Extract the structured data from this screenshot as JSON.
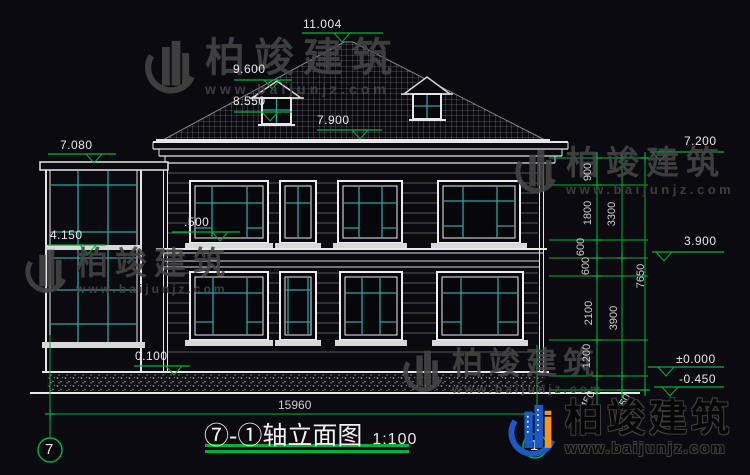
{
  "colors": {
    "background": "#0a0a10",
    "line_white": "#e6e6e6",
    "dim_green": "#00b23c",
    "glass_teal": "#2fa49e",
    "watermark_gray": "#464646",
    "logo_blue": "#1b59c4",
    "logo_orange": "#f6941e"
  },
  "labels": {
    "peak": "11.004",
    "roof_upper": "9.600",
    "roof_dormer": "8.550",
    "roof_eave": "7.900",
    "sunroom_top": "7.080",
    "sunroom_mid": "4.150",
    "floor2": ".500",
    "plinth": "0.100",
    "right_parapet": "7.200",
    "right_floor2": "3.900",
    "right_zero": "±0.000",
    "right_ground": "-0.450",
    "total_width": "15960"
  },
  "vdims": {
    "v900": "900",
    "v1800": "1800",
    "v600a": "600",
    "v600b": "600",
    "v2100": "2100",
    "v1200": "1200",
    "v450a": "450",
    "v3300": "3300",
    "v3900": "3900",
    "v450b": "450",
    "v7650": "7650"
  },
  "axes": {
    "left": "7",
    "right": "1"
  },
  "title": {
    "name": "⑦-①轴立面图",
    "scale": "1:100"
  },
  "brand": {
    "name": "柏竣建筑",
    "url": "www.baijunjz.com"
  }
}
